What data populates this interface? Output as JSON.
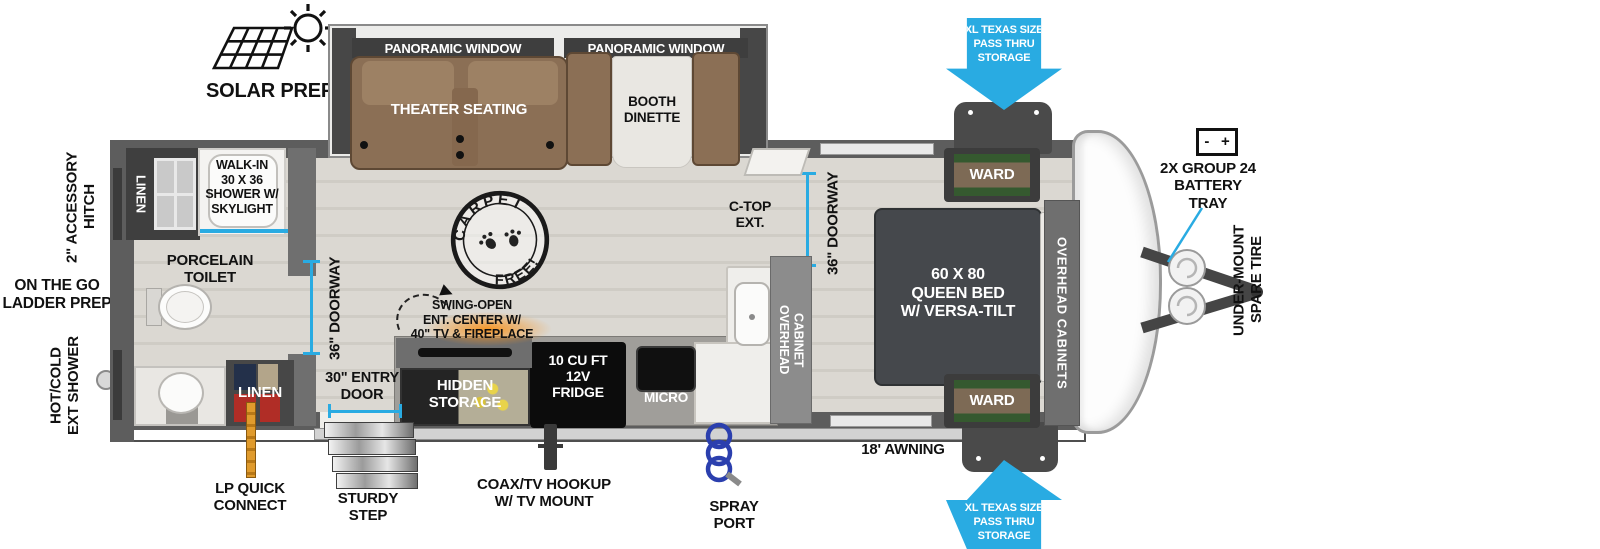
{
  "colors": {
    "accent_blue": "#29abe2",
    "wall_gray": "#5d5d5d",
    "sofa_brown": "#8b6f55",
    "appliance_black": "#0c0c0c"
  },
  "callouts_top": {
    "solar_prep": "SOLAR PREP"
  },
  "callouts_left": {
    "accessory_hitch": "2\" ACCESSORY\nHITCH",
    "ladder_prep": "ON THE GO\nLADDER PREP",
    "ext_shower": "HOT/COLD\nEXT SHOWER"
  },
  "callouts_bottom": {
    "lp_quick_connect": "LP QUICK\nCONNECT",
    "sturdy_step": "STURDY\nSTEP",
    "entry_door": "30\" ENTRY\nDOOR",
    "coax": "COAX/TV HOOKUP\nW/ TV MOUNT",
    "spray_port": "SPRAY\nPORT",
    "awning": "18' AWNING"
  },
  "callouts_right": {
    "pass_thru_top": "XL TEXAS SIZE\nPASS THRU\nSTORAGE",
    "pass_thru_bottom": "XL TEXAS SIZE\nPASS THRU\nSTORAGE",
    "battery": "2X GROUP 24\nBATTERY\nTRAY",
    "battery_icon_text": "-   +",
    "spare_tire": "UNDER-MOUNT\nSPARE TIRE"
  },
  "rooms": {
    "living": {
      "panoramic_window_left": "PANORAMIC WINDOW",
      "panoramic_window_right": "PANORAMIC WINDOW",
      "theater_seating": "THEATER SEATING",
      "booth_dinette": "BOOTH\nDINETTE",
      "carpet_top": "CARPET",
      "carpet_bottom": "FREE!",
      "swing_open": "SWING-OPEN\nENT. CENTER W/\n40\" TV & FIREPLACE"
    },
    "kitchen": {
      "hidden_storage": "HIDDEN\nSTORAGE",
      "fridge": "10 CU FT\n12V\nFRIDGE",
      "micro": "MICRO",
      "c_top_ext": "C-TOP\nEXT.",
      "overhead_cabinet": "OVERHEAD\nCABINET",
      "doorway": "36\" DOORWAY"
    },
    "bedroom": {
      "queen_bed": "60 X  80\nQUEEN BED\nW/ VERSA-TILT",
      "ward_top": "WARD",
      "ward_bottom": "WARD",
      "overhead_cabinets": "OVERHEAD CABINETS",
      "doorway": "36\" DOORWAY"
    },
    "bath": {
      "walk_in_shower": "WALK-IN\n30 X 36\nSHOWER W/\nSKYLIGHT",
      "linen_top": "LINEN",
      "linen_bottom": "LINEN",
      "porcelain_toilet": "PORCELAIN\nTOILET",
      "doorway": "36\" DOORWAY"
    }
  }
}
